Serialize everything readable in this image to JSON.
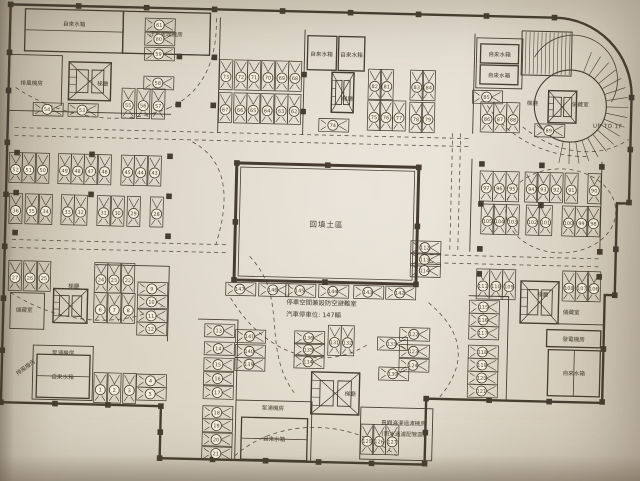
{
  "texts": {
    "backfill_area": "回填土區",
    "note_line1": "停車空間兼設防空避難室",
    "note_line2": "汽車停車位: 147輛",
    "ramp_label": "UP TO 1F"
  },
  "colors": {
    "ink": "#463d30",
    "dash": "#5a5142",
    "paper": "#e0d9ca",
    "circle_fill": "#f3ecdc"
  },
  "rooms": [
    {
      "label": "自來水箱",
      "box": [
        20,
        16,
        98,
        42
      ],
      "lx": 69,
      "ly": 32,
      "divider": "h"
    },
    {
      "label": "汙水處理機房",
      "box": [
        118,
        16,
        87,
        42
      ],
      "lx": 161,
      "ly": 40,
      "divider": ""
    },
    {
      "label": "自來水箱",
      "box": [
        303,
        36,
        29,
        34
      ],
      "lx": 317,
      "ly": 56,
      "divider": ""
    },
    {
      "label": "自來水箱",
      "box": [
        334,
        36,
        26,
        34
      ],
      "lx": 347,
      "ly": 56,
      "divider": ""
    },
    {
      "label": "自來水箱",
      "box": [
        476,
        40,
        38,
        19
      ],
      "lx": 495,
      "ly": 52,
      "divider": ""
    },
    {
      "label": "自來水箱",
      "box": [
        476,
        61,
        38,
        19
      ],
      "lx": 495,
      "ly": 73,
      "divider": ""
    },
    {
      "label": "發電機房",
      "box": [
        549,
        324,
        54,
        17
      ],
      "lx": 576,
      "ly": 335,
      "divider": ""
    },
    {
      "label": "自來水箱",
      "box": [
        551,
        344,
        52,
        46
      ],
      "lx": 577,
      "ly": 369,
      "divider": "v"
    },
    {
      "label": "自來水箱",
      "box": [
        40,
        361,
        53,
        43
      ],
      "lx": 66,
      "ly": 385,
      "divider": "h"
    },
    {
      "label": "自來水箱",
      "box": [
        246,
        419,
        66,
        42
      ],
      "lx": 279,
      "ly": 442,
      "divider": "h"
    }
  ],
  "labels": [
    {
      "t": "排風機房",
      "x": 28,
      "y": 92,
      "rot": 0
    },
    {
      "t": "梯廳",
      "x": 99,
      "y": 91,
      "rot": 0
    },
    {
      "t": "梯廳",
      "x": 344,
      "y": 100,
      "rot": 0
    },
    {
      "t": "梯廳",
      "x": 529,
      "y": 100,
      "rot": 0
    },
    {
      "t": "儲藏室",
      "x": 577,
      "y": 100,
      "rot": 0
    },
    {
      "t": "梯廳",
      "x": 544,
      "y": 291,
      "rot": 0
    },
    {
      "t": "儲藏室",
      "x": 573,
      "y": 308,
      "rot": 0
    },
    {
      "t": "儲藏室",
      "x": 26,
      "y": 319,
      "rot": 0
    },
    {
      "t": "梯廳",
      "x": 75,
      "y": 294,
      "rot": 0
    },
    {
      "t": "泵浦機房",
      "x": 66,
      "y": 361,
      "rot": 0
    },
    {
      "t": "排風機房",
      "x": 30,
      "y": 376,
      "rot": -38
    },
    {
      "t": "泵浦機房",
      "x": 277,
      "y": 411,
      "rot": 0
    },
    {
      "t": "梯廳",
      "x": 354,
      "y": 395,
      "rot": 0
    },
    {
      "t": "景觀澆灌過濾機房",
      "x": 408,
      "y": 423,
      "rot": 0
    },
    {
      "t": "(雨水過濾配管區)",
      "x": 408,
      "y": 434,
      "rot": 0
    }
  ],
  "stalls": [
    [
      1,
      104,
      393,
      "v"
    ],
    [
      2,
      118,
      393,
      "v"
    ],
    [
      3,
      133,
      393,
      "v"
    ],
    [
      4,
      155,
      385,
      "h"
    ],
    [
      5,
      155,
      398,
      "h"
    ],
    [
      6,
      102,
      313,
      "v"
    ],
    [
      7,
      116,
      313,
      "v"
    ],
    [
      8,
      130,
      313,
      "v"
    ],
    [
      9,
      154,
      293,
      "h"
    ],
    [
      10,
      154,
      306,
      "h"
    ],
    [
      11,
      154,
      320,
      "h"
    ],
    [
      12,
      154,
      333,
      "h"
    ],
    [
      13,
      222,
      333,
      "h"
    ],
    [
      14,
      222,
      351,
      "h"
    ],
    [
      15,
      222,
      367,
      "h"
    ],
    [
      16,
      222,
      381,
      "h"
    ],
    [
      17,
      222,
      395,
      "h"
    ],
    [
      18,
      222,
      415,
      "h"
    ],
    [
      19,
      222,
      428,
      "h"
    ],
    [
      20,
      222,
      442,
      "h"
    ],
    [
      21,
      222,
      456,
      "h"
    ],
    [
      22,
      129,
      283,
      "v"
    ],
    [
      23,
      115,
      283,
      "v"
    ],
    [
      24,
      102,
      283,
      "v"
    ],
    [
      25,
      45,
      283,
      "v"
    ],
    [
      26,
      31,
      283,
      "v"
    ],
    [
      27,
      16,
      283,
      "v"
    ],
    [
      28,
      156,
      216,
      "v"
    ],
    [
      29,
      133,
      216,
      "v"
    ],
    [
      30,
      117,
      216,
      "v"
    ],
    [
      31,
      103,
      216,
      "v"
    ],
    [
      32,
      80,
      216,
      "v"
    ],
    [
      33,
      67,
      216,
      "v"
    ],
    [
      34,
      45,
      216,
      "v"
    ],
    [
      35,
      31,
      216,
      "v"
    ],
    [
      36,
      15,
      216,
      "v"
    ],
    [
      43,
      153,
      175,
      "v"
    ],
    [
      44,
      139,
      175,
      "v"
    ],
    [
      45,
      126,
      175,
      "v"
    ],
    [
      46,
      103,
      175,
      "v"
    ],
    [
      47,
      89,
      175,
      "v"
    ],
    [
      48,
      76,
      175,
      "v"
    ],
    [
      49,
      63,
      175,
      "v"
    ],
    [
      50,
      41,
      175,
      "v"
    ],
    [
      51,
      27,
      175,
      "v"
    ],
    [
      52,
      14,
      175,
      "v"
    ],
    [
      53,
      80,
      116,
      "h"
    ],
    [
      54,
      45,
      116,
      "h"
    ],
    [
      55,
      125,
      108,
      "v"
    ],
    [
      56,
      140,
      108,
      "v"
    ],
    [
      57,
      155,
      108,
      "v"
    ],
    [
      58,
      155,
      87,
      "h"
    ],
    [
      59,
      155,
      58,
      "h"
    ],
    [
      60,
      155,
      43,
      "h"
    ],
    [
      61,
      155,
      29,
      "h"
    ],
    [
      62,
      291,
      110,
      "v"
    ],
    [
      63,
      278,
      110,
      "v"
    ],
    [
      64,
      264,
      110,
      "v"
    ],
    [
      65,
      250,
      110,
      "v"
    ],
    [
      66,
      237,
      110,
      "v"
    ],
    [
      67,
      222,
      110,
      "v"
    ],
    [
      68,
      291,
      77,
      "v"
    ],
    [
      69,
      278,
      77,
      "v"
    ],
    [
      70,
      264,
      77,
      "v"
    ],
    [
      71,
      250,
      77,
      "v"
    ],
    [
      72,
      237,
      77,
      "v"
    ],
    [
      73,
      222,
      77,
      "v"
    ],
    [
      74,
      331,
      125,
      "h"
    ],
    [
      75,
      371,
      114,
      "v"
    ],
    [
      76,
      383,
      114,
      "v"
    ],
    [
      77,
      396,
      114,
      "v"
    ],
    [
      78,
      413,
      115,
      "v"
    ],
    [
      79,
      425,
      115,
      "v"
    ],
    [
      82,
      371,
      83,
      "v"
    ],
    [
      81,
      383,
      83,
      "v"
    ],
    [
      83,
      413,
      83,
      "v"
    ],
    [
      84,
      425,
      83,
      "v"
    ],
    [
      85,
      484,
      93,
      "h"
    ],
    [
      86,
      484,
      113,
      "v"
    ],
    [
      87,
      497,
      113,
      "v"
    ],
    [
      88,
      510,
      113,
      "v"
    ],
    [
      89,
      547,
      125,
      "h"
    ],
    [
      97,
      485,
      182,
      "v"
    ],
    [
      96,
      498,
      182,
      "v"
    ],
    [
      95,
      511,
      182,
      "v"
    ],
    [
      94,
      530,
      182,
      "v"
    ],
    [
      93,
      542,
      182,
      "v"
    ],
    [
      92,
      555,
      182,
      "v"
    ],
    [
      91,
      570,
      182,
      "v"
    ],
    [
      90,
      593,
      182,
      "v"
    ],
    [
      105,
      487,
      215,
      "v"
    ],
    [
      104,
      499,
      215,
      "v"
    ],
    [
      103,
      512,
      215,
      "v"
    ],
    [
      102,
      532,
      215,
      "v"
    ],
    [
      101,
      545,
      215,
      "v"
    ],
    [
      100,
      568,
      215,
      "v"
    ],
    [
      99,
      581,
      215,
      "v"
    ],
    [
      98,
      593,
      215,
      "v"
    ],
    [
      111,
      484,
      280,
      "v"
    ],
    [
      110,
      497,
      280,
      "v"
    ],
    [
      109,
      510,
      280,
      "v"
    ],
    [
      108,
      570,
      280,
      "v"
    ],
    [
      107,
      583,
      280,
      "v"
    ],
    [
      106,
      595,
      280,
      "v"
    ],
    [
      112,
      426,
      245,
      "h"
    ],
    [
      113,
      426,
      257,
      "h"
    ],
    [
      114,
      426,
      268,
      "h"
    ],
    [
      115,
      486,
      303,
      "h"
    ],
    [
      116,
      486,
      316,
      "h"
    ],
    [
      117,
      486,
      329,
      "h"
    ],
    [
      118,
      486,
      348,
      "h"
    ],
    [
      119,
      486,
      361,
      "h"
    ],
    [
      120,
      486,
      374,
      "h"
    ],
    [
      121,
      486,
      387,
      "h"
    ],
    [
      122,
      417,
      332,
      "h"
    ],
    [
      123,
      417,
      349,
      "h"
    ],
    [
      124,
      417,
      363,
      "h"
    ],
    [
      125,
      372,
      438,
      "v"
    ],
    [
      126,
      384,
      438,
      "v"
    ],
    [
      127,
      397,
      438,
      "v"
    ],
    [
      130,
      397,
      372,
      "h"
    ],
    [
      133,
      395,
      342,
      "h"
    ],
    [
      131,
      337,
      340,
      "v"
    ],
    [
      132,
      350,
      340,
      "v"
    ],
    [
      134,
      312,
      362,
      "h"
    ],
    [
      135,
      312,
      350,
      "h"
    ],
    [
      136,
      312,
      338,
      "h"
    ],
    [
      139,
      253,
      366,
      "h"
    ],
    [
      140,
      253,
      353,
      "h"
    ],
    [
      141,
      253,
      338,
      "h"
    ],
    [
      142,
      402,
      291,
      "h"
    ],
    [
      143,
      370,
      291,
      "h"
    ],
    [
      144,
      335,
      291,
      "h"
    ],
    [
      145,
      302,
      291,
      "h"
    ],
    [
      146,
      275,
      291,
      "h"
    ],
    [
      147,
      242,
      291,
      "h"
    ]
  ],
  "lanes": [
    "M12,135 H468",
    "M12,143 H468",
    "M12,247 H226",
    "M12,255 H226",
    "M430,252 H600",
    "M430,260 H600",
    "M450,130 V248",
    "M458,130 V248",
    "M12,95 C60,125 120,132 165,112",
    "M165,112 C200,96 213,62 211,20",
    "M190,145 C228,164 228,205 216,247",
    "M505,205 a55,42 0 1 0 110,0 a55,42 0 1 0 -110,0",
    "M480,95 C500,130 540,152 586,150",
    "M520,122 C556,150 598,152 626,132",
    "M232,300 C270,360 330,372 372,342",
    "M250,258 C292,300 262,350 300,396",
    "M430,300 C468,330 470,362 442,396",
    "M240,458 C280,420 352,416 402,454",
    "M12,300 C60,330 122,334 164,310"
  ]
}
